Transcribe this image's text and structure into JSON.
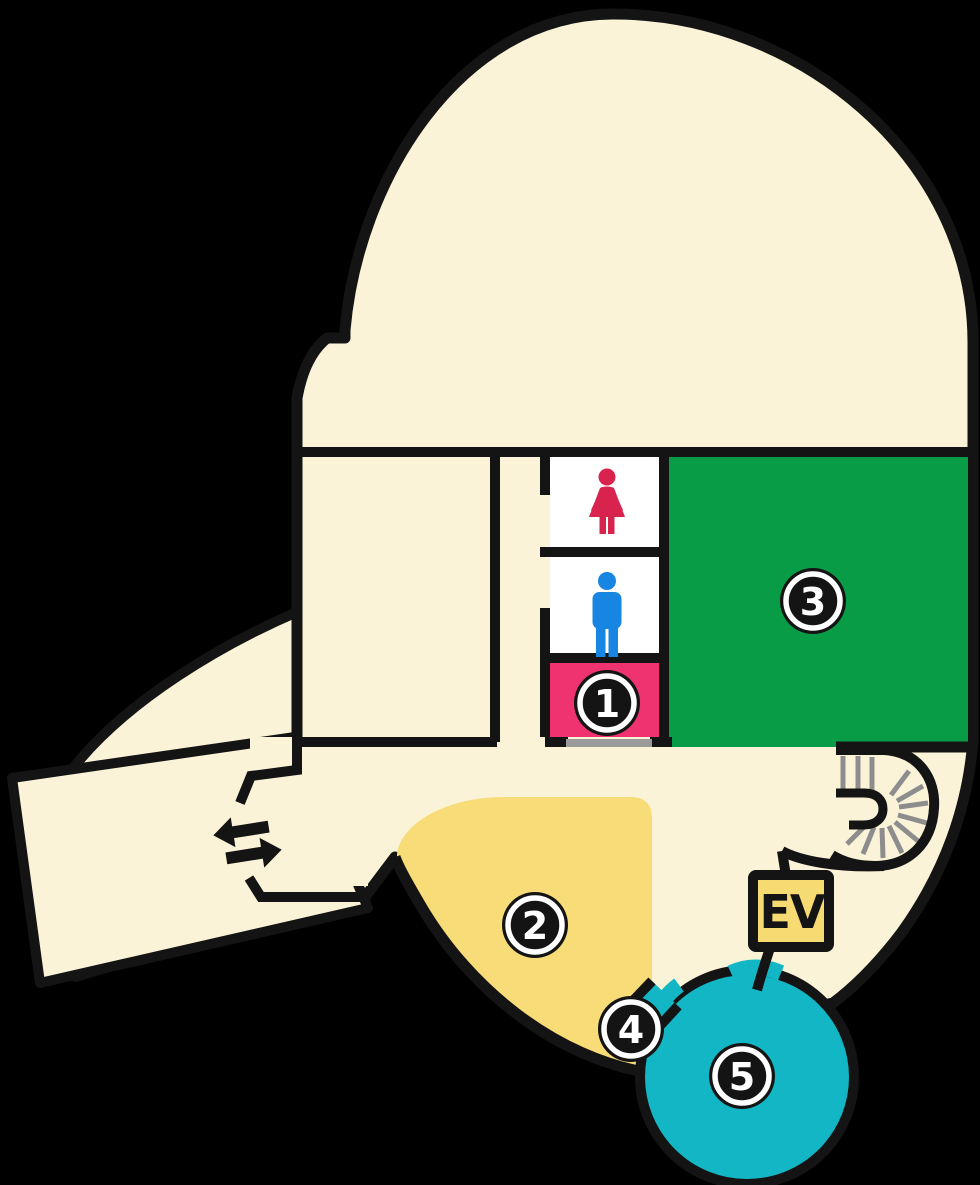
{
  "map": {
    "type": "facility-floor-map",
    "badges": [
      {
        "number": "1",
        "area_color": "#EF3370"
      },
      {
        "number": "2",
        "area_color": "#F8DC78"
      },
      {
        "number": "3",
        "area_color": "#099C46"
      },
      {
        "number": "4",
        "area_color": "#FBF3D8"
      },
      {
        "number": "5",
        "area_color": "#13B6C4"
      }
    ],
    "elevator_label": "EV",
    "icons": [
      {
        "name": "female-restroom-icon",
        "color": "#D7234D"
      },
      {
        "name": "male-restroom-icon",
        "color": "#1786E2"
      },
      {
        "name": "spiral-stairs-icon",
        "color": "#8D8D8D"
      },
      {
        "name": "entrance-arrows-icon",
        "color": "#141414"
      }
    ],
    "colors": {
      "background": "#000000",
      "building_fill": "#FBF3D8",
      "outline": "#141414",
      "room_1_pink": "#EF3370",
      "room_2_yellow": "#F8DC78",
      "room_3_green": "#099C46",
      "room_5_teal": "#13B6C4",
      "elevator_yellow": "#F5DB72",
      "restroom_white": "#FFFFFF",
      "stairs_gray": "#8D8D8D",
      "door_gray": "#9A9A9A"
    }
  }
}
